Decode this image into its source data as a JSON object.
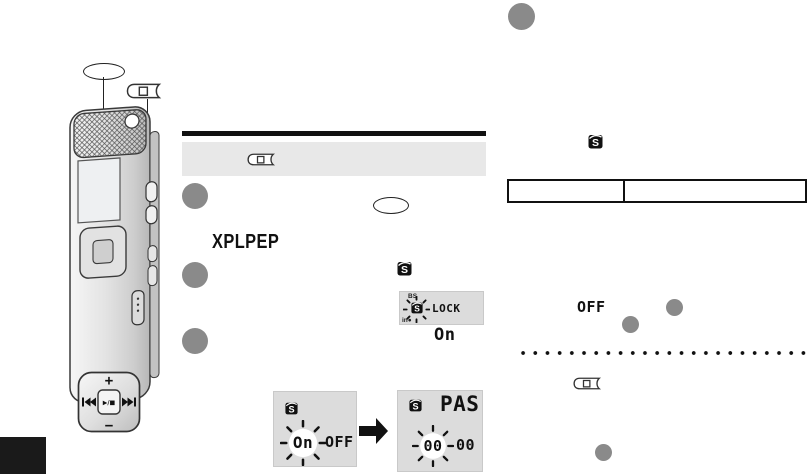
{
  "colors": {
    "step_circle": "#8a8a8a",
    "screen_bg": "#dcdcdc",
    "panel_bg": "#e8e8e8",
    "ink": "#111111"
  },
  "icons": {
    "s_letter": "S"
  },
  "illustration": {
    "dpad_plus": "+",
    "dpad_minus": "−",
    "dpad_center": "▶/■"
  },
  "left_column": {
    "mode_label": "XPLPEP",
    "screen_lock": {
      "indicator_top": "BS",
      "label": "LOCK",
      "indicator_bottom": "in●",
      "value_below": "On"
    },
    "screen_onoff": {
      "blink_value": "On",
      "off_value": "OFF"
    },
    "screen_pass": {
      "title": "PAS",
      "code_blink": "00",
      "code_rest": "00"
    }
  },
  "right_column": {
    "off_value": "OFF"
  }
}
